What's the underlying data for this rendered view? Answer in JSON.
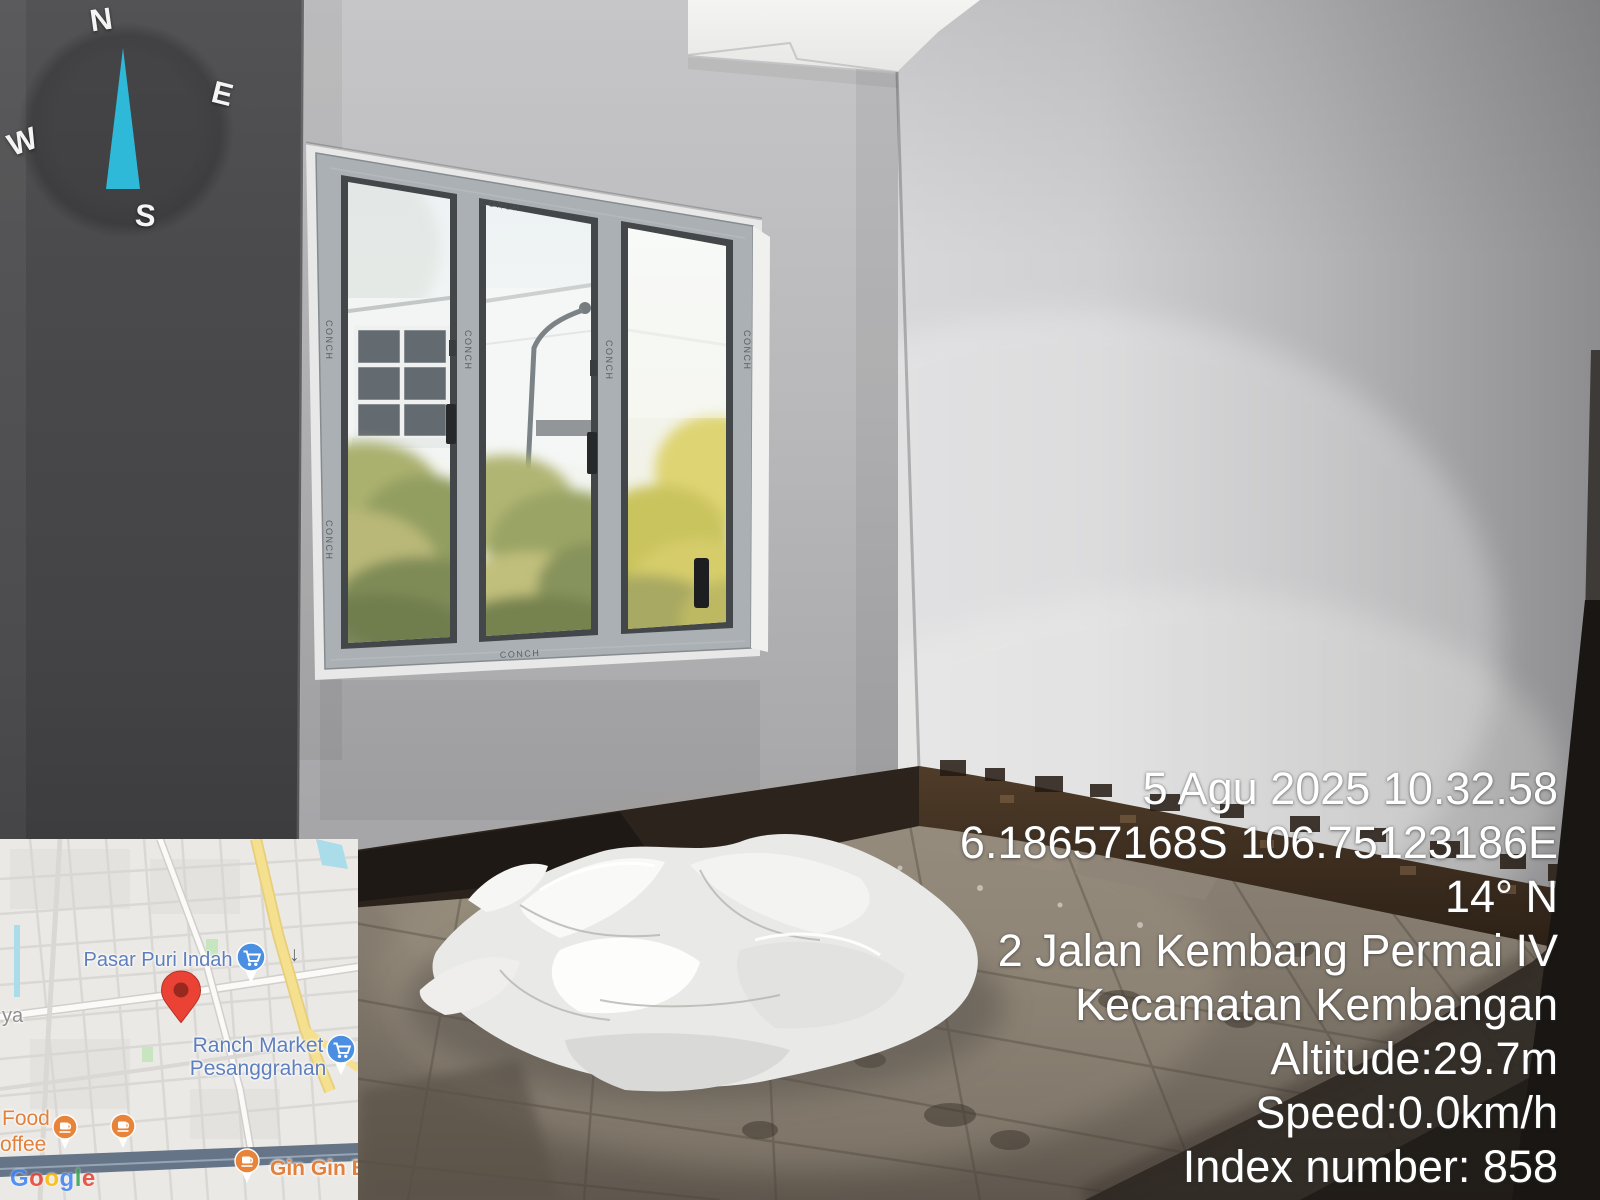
{
  "gps_stamp": {
    "lines": [
      "5 Agu 2025 10.32.58",
      "6.18657168S 106.75123186E",
      "14° N",
      "2 Jalan Kembang Permai IV",
      "Kecamatan Kembangan",
      "Altitude:29.7m",
      "Speed:0.0km/h",
      "Index number: 858"
    ],
    "text_color": "#ffffff"
  },
  "compass": {
    "north": "N",
    "east": "E",
    "south": "S",
    "west": "W",
    "needle_color": "#2fb9d8"
  },
  "map": {
    "labels": {
      "market1": "Pasar Puri Indah",
      "market2_line1": "Ranch Market",
      "market2_line2": "Pesanggrahan",
      "street_partial": "ya",
      "food_partial": "Food",
      "coffee_partial": "offee",
      "poi_partial": "Gin Gin Ba"
    },
    "attribution": {
      "letters": [
        {
          "ch": "G"
        },
        {
          "ch": "o"
        },
        {
          "ch": "o"
        },
        {
          "ch": "g"
        },
        {
          "ch": "l"
        },
        {
          "ch": "e"
        }
      ]
    },
    "icons": {
      "down_arrow_glyph": "↓"
    },
    "colors": {
      "poi_label_blue": "#5e7fbe",
      "poi_label_orange": "#e2813d",
      "pin_red": "#ea4335",
      "pin_blue": "#4a8fe2",
      "pin_orange": "#e8833a",
      "road_yellow": "#f4df88",
      "water_cyan": "#a6dbe9",
      "highway_blue": "#5d6d80",
      "park_green": "#c4e4bc"
    }
  },
  "window_film": {
    "brand": "CONCH"
  }
}
